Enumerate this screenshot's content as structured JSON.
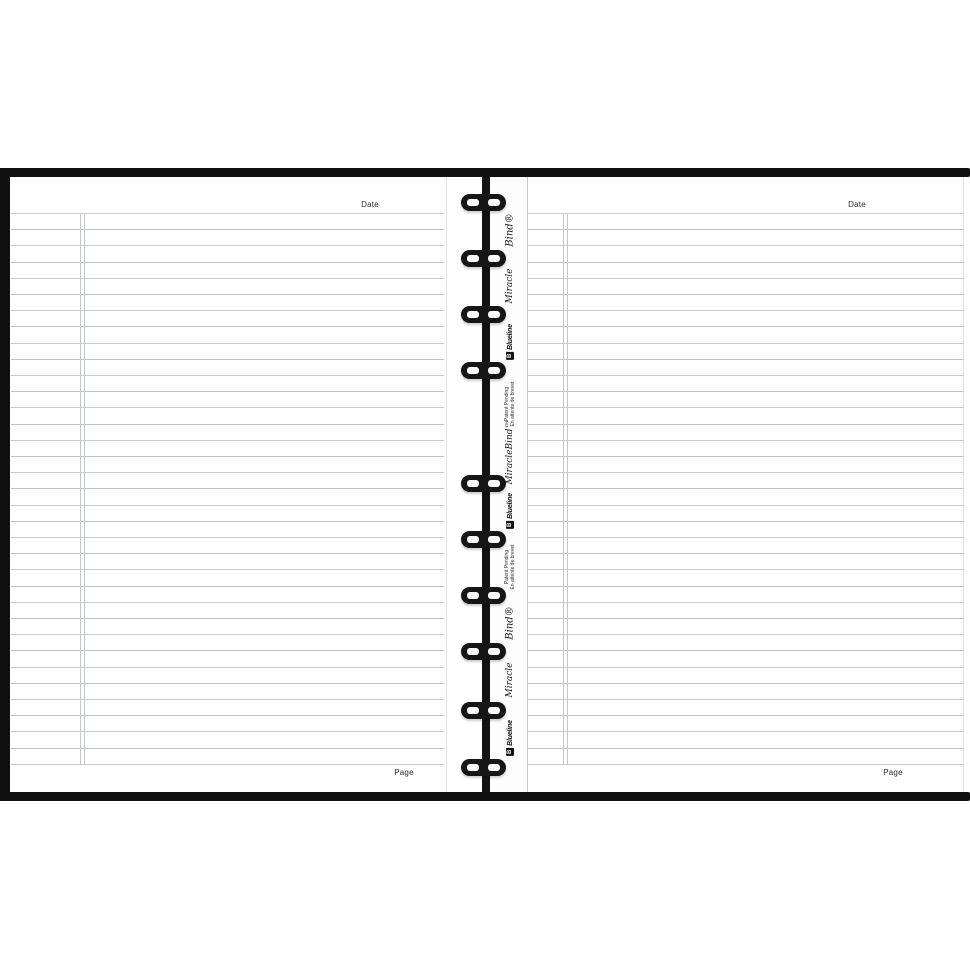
{
  "product": "open ruled notebook with twin-ring binding",
  "colors": {
    "cover_black": "#101010",
    "paper_white": "#fefefe",
    "rule_gray": "#c9cccf",
    "margin_gray": "#c4c8ca"
  },
  "left_page": {
    "date_label": "Date",
    "page_label": "Page"
  },
  "right_page": {
    "date_label": "Date",
    "page_label": "Page"
  },
  "ruling": {
    "lines_per_page": 35,
    "has_left_margin_double_line": true
  },
  "rings": {
    "count": 10
  },
  "spine": {
    "items": [
      {
        "type": "script_big",
        "text": "Bind®"
      },
      {
        "type": "script",
        "text": "Miracle"
      },
      {
        "type": "logo",
        "text": "Blueline",
        "icon_letter": "B"
      },
      {
        "type": "patent",
        "line1": "Patent Pending",
        "line2": "En attente de brevet"
      },
      {
        "type": "script",
        "text": "MiracleBind™"
      },
      {
        "type": "logo",
        "text": "Blueline",
        "icon_letter": "B"
      },
      {
        "type": "patent",
        "line1": "Patent Pending",
        "line2": "En attente de brevet"
      },
      {
        "type": "script_big",
        "text": "Bind®"
      },
      {
        "type": "script",
        "text": "Miracle"
      },
      {
        "type": "logo",
        "text": "Blueline",
        "icon_letter": "B"
      }
    ]
  }
}
